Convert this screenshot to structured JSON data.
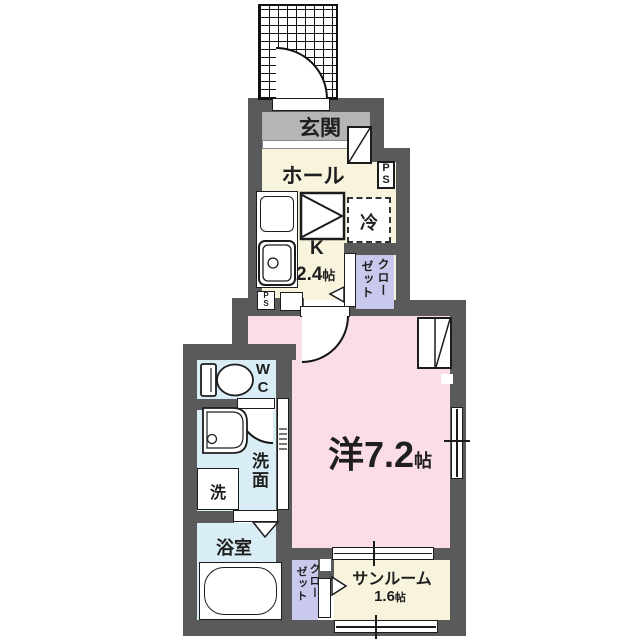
{
  "title": "1K apartment floor plan",
  "colors": {
    "wall": "#5a5a5a",
    "genkan_floor": "#b5b5b5",
    "wood_floor": "#f8f3dc",
    "room_floor": "#fadde6",
    "wet_floor": "#d8edf5",
    "closet": "#c9c9ee",
    "line": "#1c1c1c"
  },
  "rooms": {
    "genkan": "玄関",
    "hall": "ホール",
    "kitchen": "K",
    "kitchen_size": "2.4",
    "kitchen_unit": "帖",
    "fridge": "冷",
    "closet_upper_col_right": "クロー",
    "closet_upper_col_left": "ゼット",
    "ps_right_1": "P",
    "ps_right_2": "S",
    "ps_left_1": "P",
    "ps_left_2": "S",
    "main_room": "洋7.2",
    "main_room_unit": "帖",
    "wc_1": "W",
    "wc_2": "C",
    "washroom": "洗面",
    "washer": "洗",
    "bathroom": "浴室",
    "closet_lower_col_right": "クロー",
    "closet_lower_col_left": "ゼット",
    "sunroom": "サンルーム",
    "sunroom_size": "1.6",
    "sunroom_unit": "帖"
  }
}
